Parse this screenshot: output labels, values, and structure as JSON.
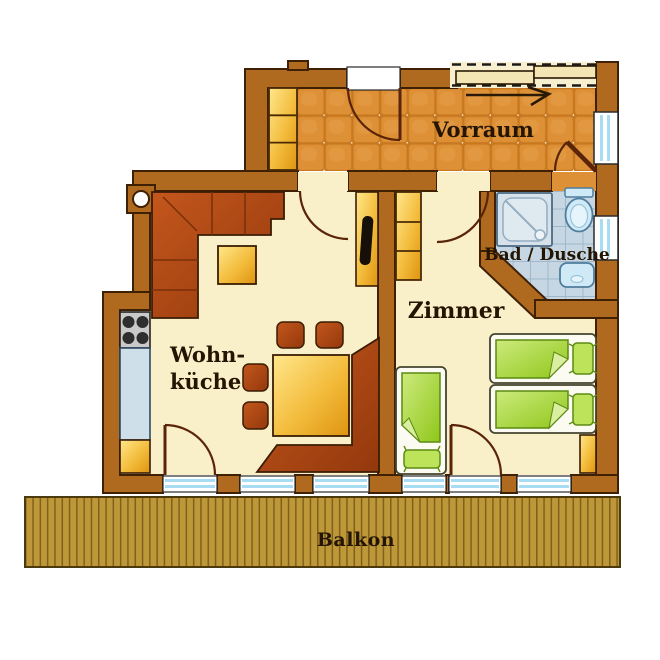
{
  "type": "floor-plan",
  "rooms": {
    "vorraum": {
      "label": "Vorraum"
    },
    "bad_dusche": {
      "label": "Bad / Dusche"
    },
    "zimmer": {
      "label": "Zimmer"
    },
    "wohnkueche": {
      "label_line1": "Wohn-",
      "label_line2": "küche"
    },
    "balkon": {
      "label": "Balkon"
    }
  },
  "colors": {
    "wall": "#B06A20",
    "wall_outline": "#3E2005",
    "vorraum_tile": "#DE9036",
    "vorraum_tile_gap": "#C8791F",
    "cream_floor": "#F9EFC8",
    "bath_floor": "#C6D6E2",
    "bath_grid": "#9FB9CB",
    "deck": "#BE9739",
    "deck_stripe": "#7E611A",
    "window_glass": "#A8DCF2",
    "furniture_dark": "#B24A18",
    "furniture_yellow": "#F2B83A",
    "bed_green": "#9FD42F",
    "fixture_blue": "#CFE9F6",
    "counter_blue": "#CFDFEA",
    "label_text": "#241503"
  },
  "furniture": {
    "vorraum": [
      "wardrobe",
      "sliding-door",
      "entrance-door"
    ],
    "wohnkueche": [
      "corner-sofa",
      "coffee-table",
      "dining-table",
      "corner-bench",
      "chair",
      "chair",
      "chair",
      "chair",
      "stove",
      "kitchen-counter",
      "base-cabinet",
      "tv-sideboard"
    ],
    "zimmer": [
      "wardrobe",
      "double-bed",
      "single-bed",
      "nightstand"
    ],
    "bad_dusche": [
      "shower",
      "toilet",
      "sink"
    ]
  }
}
